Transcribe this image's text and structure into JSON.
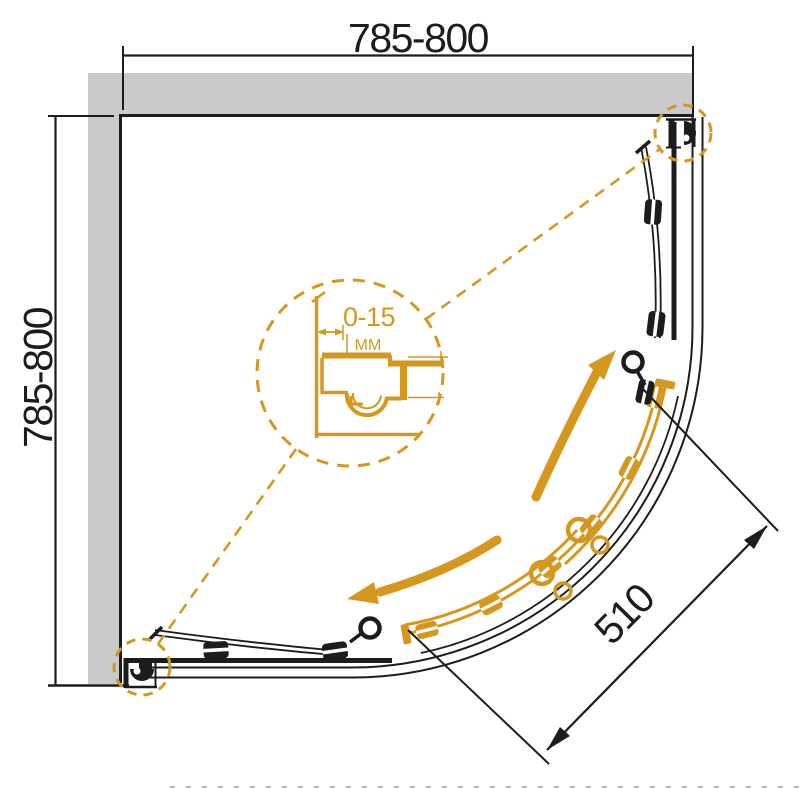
{
  "drawing": {
    "type": "technical-plan-diagram",
    "subject": "quadrant shower enclosure top view with sliding doors",
    "dimensions": {
      "width_top": "785-800",
      "depth_left": "785-800",
      "door_opening_diagonal": "510",
      "wall_adjustment_range": "0-15",
      "wall_adjustment_unit": "MM"
    },
    "colors": {
      "accent_orange": "#d6971f",
      "wall_gray": "#c9cacb",
      "line_black": "#1c1c1c"
    }
  }
}
